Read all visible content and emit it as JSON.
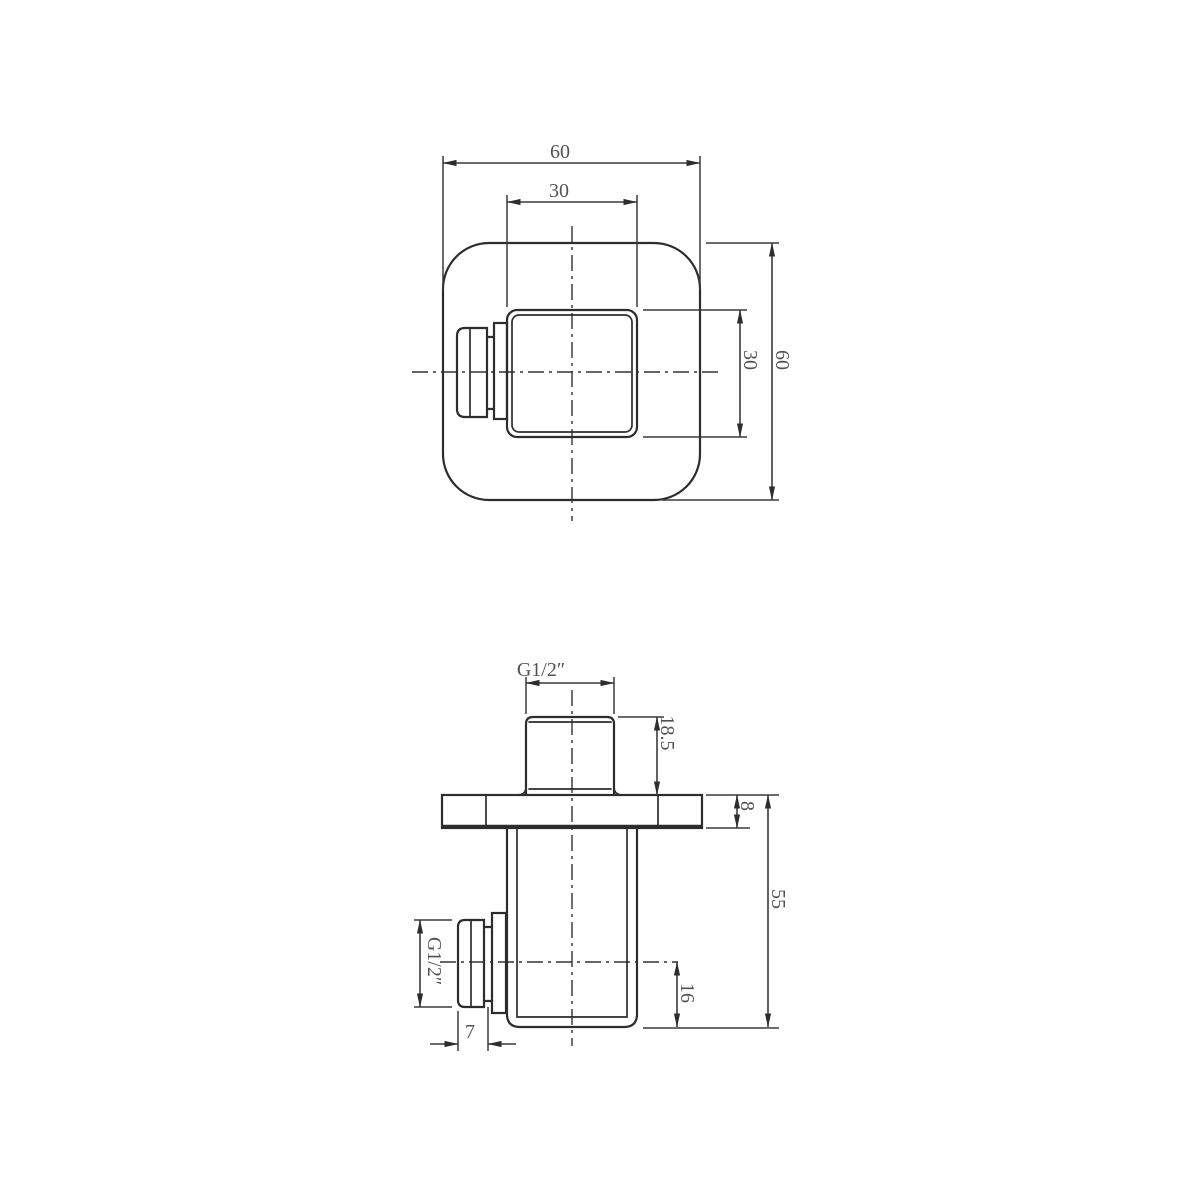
{
  "drawing": {
    "title": "square-wall-outlet-technical-drawing",
    "background": "#ffffff",
    "line_color": "#2d2d2d",
    "text_color": "#525252",
    "views": {
      "front_view": {
        "name": "front view (wall plate)",
        "dims": {
          "plate_width": "60",
          "body_width": "30",
          "body_height": "30",
          "plate_height": "60"
        }
      },
      "side_view": {
        "name": "side view (profile)",
        "dims": {
          "top_thread": "G1/2″",
          "stub_height": "18.5",
          "plate_thickness": "8",
          "total_depth": "55",
          "side_thread": "G1/2″",
          "side_thread_length": "7",
          "outlet_center_to_base": "16"
        }
      }
    }
  }
}
